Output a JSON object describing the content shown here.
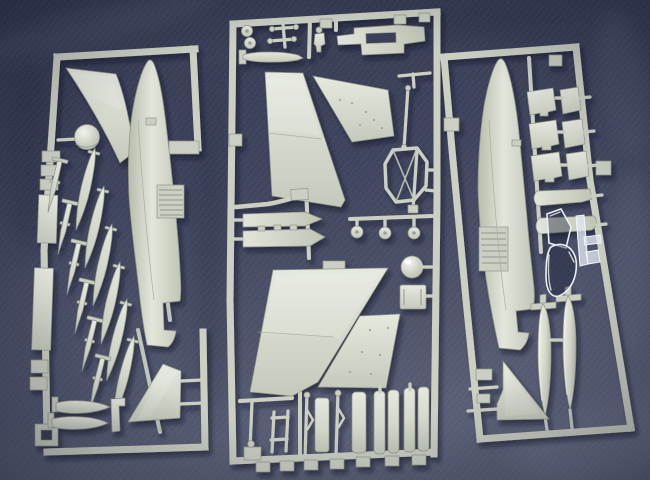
{
  "scene": {
    "type": "photograph",
    "subject": "Three light-grey injection-moulded polystyrene sprues of a 1/72 jet aircraft plastic model kit, photographed from above on dark blue woven fabric",
    "lighting": "flash from upper left, soft shadows cast down-right of each sprue",
    "sprues": {
      "left_sprue": {
        "position": "left",
        "parts": [
          "port fuselage half with ribbed speed-brake detail",
          "swept wing panel",
          "domed nose cap",
          "fan of 12 rockets and slender bombs",
          "flap and actuator strips on outer rail",
          "2 finned bombs lying horizontally",
          "small gun pod",
          "tail fin half (triangle)"
        ]
      },
      "center_sprue": {
        "position": "center",
        "parts": [
          "2 upper wing panels",
          "2 lower wing panels",
          "pair of main wheels",
          "cross-shaped gear retraction struts",
          "pilot figure",
          "cockpit sled / seat rail part",
          "horizontal torpedo-shaped store",
          "bent intake pipe",
          "2 exhaust duct halves",
          "octagonal intake frame",
          "2 long gear struts",
          "radome ball",
          "3 small wheels on runner",
          "nose gear leg assemblies",
          "6 long landing-gear doors",
          "7 molding tabs along bottom rail"
        ]
      },
      "right_sprue": {
        "position": "right",
        "parts": [
          "starboard fuselage half with ribbed intake detail",
          "6 stacked weapon pylons",
          "2 missile launcher rails with rounded ends",
          "clear windscreen",
          "clear canopy",
          "clear sprue runner",
          "2 teardrop drop tanks with cruciform fins",
          "tail fin half (triangle)",
          "small tabs on outer rails"
        ]
      }
    }
  },
  "palette": {
    "fabric_dark": "#272c45",
    "fabric_mid": "#3a4059",
    "fabric_light": "#565c75",
    "fabric_corner_light": "#6e7490",
    "plastic": "#cbd0c3",
    "plastic_light": "#e7eadf",
    "plastic_shadow": "#949b8b",
    "clear_highlight": "#f4f7fb",
    "shadow": "#0d1126"
  }
}
